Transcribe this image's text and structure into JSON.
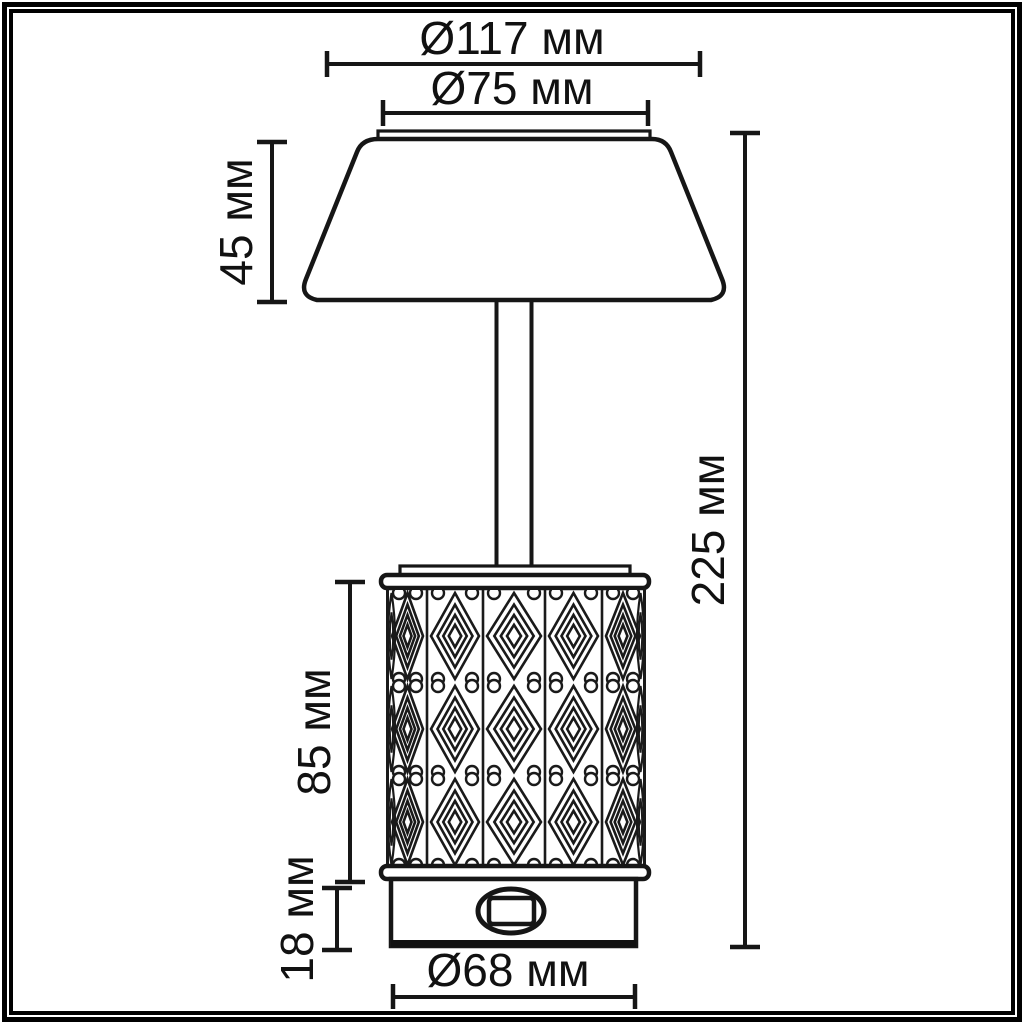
{
  "units": "мм",
  "dims": {
    "shade_outer_diameter": "Ø117 мм",
    "shade_inner_diameter": "Ø75 мм",
    "shade_height": "45 мм",
    "total_height": "225 мм",
    "body_height": "85 мм",
    "base_height": "18 мм",
    "base_diameter": "Ø68 мм"
  },
  "colors": {
    "line": "#161616",
    "pattern_line": "#1a1a1a",
    "text": "#111111",
    "frame": "#000000",
    "background": "#ffffff"
  }
}
